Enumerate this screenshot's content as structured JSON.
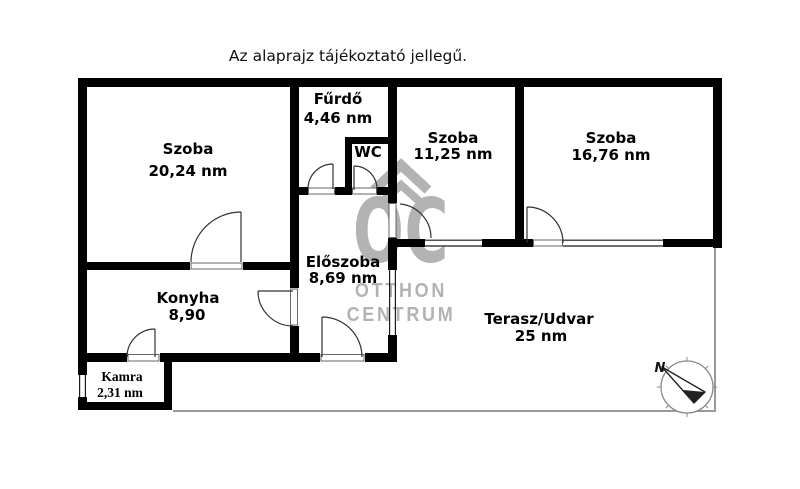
{
  "title": "Az alaprajz tájékoztató jellegű.",
  "rooms": {
    "szoba1": {
      "name": "Szoba",
      "area": "20,24 nm"
    },
    "furdo": {
      "name": "Fűrdő",
      "area": "4,46 nm"
    },
    "wc": {
      "name": "WC"
    },
    "szoba2": {
      "name": "Szoba",
      "area": "11,25 nm"
    },
    "szoba3": {
      "name": "Szoba",
      "area": "16,76 nm"
    },
    "eloszoba": {
      "name": "Előszoba",
      "area": "8,69 nm"
    },
    "konyha": {
      "name": "Konyha",
      "area": "8,90"
    },
    "kamra": {
      "name": "Kamra",
      "area": "2,31 nm"
    },
    "terasz": {
      "name": "Terasz/Udvar",
      "area": "25 nm"
    }
  },
  "watermark": {
    "logo": "OC",
    "line1": "OTTHON",
    "line2": "CENTRUM"
  },
  "compass": {
    "north": "N"
  },
  "colors": {
    "wall": "#000000",
    "watermark": "#b3b3b3",
    "terrace_line": "#999999",
    "arc": "#333333"
  }
}
